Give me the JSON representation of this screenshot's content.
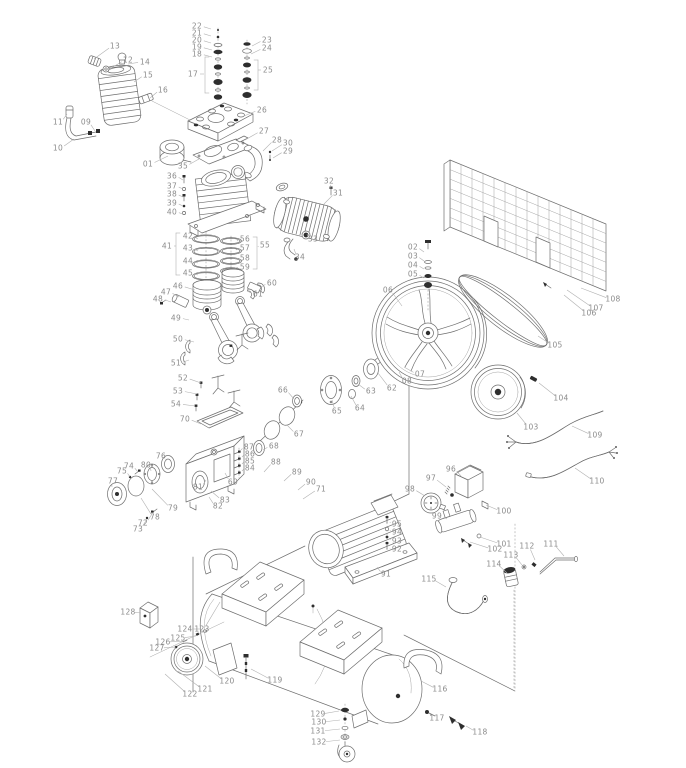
{
  "canvas": {
    "width": 686,
    "height": 768,
    "background": "#ffffff"
  },
  "style": {
    "line_color": "#6e6e6e",
    "label_color": "#8b8b8b",
    "leader_color": "#b1b1b1",
    "dark_fill": "#2e2e2e"
  },
  "callouts": [
    [
      "01",
      148,
      164,
      168,
      156
    ],
    [
      "02",
      413,
      247,
      424,
      252
    ],
    [
      "03",
      413,
      256,
      424,
      261
    ],
    [
      "04",
      413,
      265,
      424,
      269
    ],
    [
      "05",
      413,
      274,
      424,
      278
    ],
    [
      "06",
      388,
      290,
      402,
      306
    ],
    [
      "07",
      420,
      374,
      404,
      367
    ],
    [
      "08",
      407,
      381,
      399,
      372
    ],
    [
      "09",
      86,
      122,
      95,
      131
    ],
    [
      "10",
      58,
      148,
      74,
      139
    ],
    [
      "11",
      58,
      122,
      67,
      114
    ],
    [
      "12",
      128,
      60,
      108,
      70
    ],
    [
      "13",
      115,
      46,
      94,
      59
    ],
    [
      "14",
      145,
      62,
      128,
      64
    ],
    [
      "15",
      148,
      75,
      134,
      82
    ],
    [
      "16",
      163,
      90,
      150,
      98
    ],
    [
      "17",
      193,
      74,
      204,
      74
    ],
    [
      "18",
      197,
      54,
      212,
      57
    ],
    [
      "19",
      197,
      47,
      212,
      50
    ],
    [
      "20",
      197,
      40,
      211,
      43
    ],
    [
      "21",
      197,
      33,
      211,
      36
    ],
    [
      "22",
      197,
      26,
      211,
      29
    ],
    [
      "23",
      267,
      40,
      252,
      46
    ],
    [
      "24",
      267,
      48,
      251,
      54
    ],
    [
      "25",
      268,
      70,
      258,
      70
    ],
    [
      "26",
      262,
      110,
      244,
      116
    ],
    [
      "27",
      264,
      131,
      245,
      140
    ],
    [
      "28",
      277,
      140,
      263,
      151
    ],
    [
      "29",
      288,
      151,
      273,
      158
    ],
    [
      "30",
      288,
      143,
      272,
      151
    ],
    [
      "31",
      338,
      193,
      324,
      204
    ],
    [
      "32",
      329,
      181,
      331,
      189
    ],
    [
      "33",
      313,
      239,
      307,
      234
    ],
    [
      "34",
      300,
      257,
      294,
      249
    ],
    [
      "35",
      183,
      166,
      199,
      159
    ],
    [
      "36",
      172,
      176,
      183,
      180
    ],
    [
      "37",
      172,
      186,
      183,
      189
    ],
    [
      "38",
      172,
      194,
      183,
      197
    ],
    [
      "39",
      172,
      203,
      183,
      206
    ],
    [
      "40",
      172,
      212,
      183,
      214
    ],
    [
      "41",
      167,
      246,
      176,
      246
    ],
    [
      "42",
      188,
      236,
      198,
      239
    ],
    [
      "43",
      188,
      248,
      198,
      251
    ],
    [
      "44",
      188,
      261,
      198,
      263
    ],
    [
      "45",
      188,
      273,
      198,
      275
    ],
    [
      "46",
      178,
      286,
      195,
      290
    ],
    [
      "47",
      166,
      292,
      179,
      297
    ],
    [
      "48",
      158,
      299,
      171,
      302
    ],
    [
      "49",
      176,
      318,
      189,
      320
    ],
    [
      "50",
      178,
      339,
      194,
      342
    ],
    [
      "51",
      176,
      363,
      189,
      360
    ],
    [
      "52",
      183,
      378,
      201,
      383
    ],
    [
      "53",
      178,
      391,
      197,
      394
    ],
    [
      "54",
      176,
      404,
      195,
      406
    ],
    [
      "55",
      265,
      245,
      258,
      247
    ],
    [
      "56",
      245,
      239,
      237,
      241
    ],
    [
      "57",
      245,
      248,
      236,
      250
    ],
    [
      "58",
      245,
      258,
      235,
      259
    ],
    [
      "59",
      245,
      267,
      235,
      268
    ],
    [
      "60",
      272,
      283,
      261,
      287
    ],
    [
      "61",
      258,
      294,
      247,
      291
    ],
    [
      "62",
      392,
      388,
      378,
      373
    ],
    [
      "63",
      371,
      391,
      358,
      384
    ],
    [
      "64",
      360,
      408,
      351,
      396
    ],
    [
      "65",
      337,
      411,
      332,
      400
    ],
    [
      "66",
      283,
      390,
      294,
      399
    ],
    [
      "67",
      299,
      434,
      287,
      425
    ],
    [
      "68",
      274,
      446,
      263,
      450
    ],
    [
      "69",
      233,
      482,
      225,
      473
    ],
    [
      "70",
      185,
      419,
      201,
      424
    ],
    [
      "71",
      321,
      489,
      303,
      499
    ],
    [
      "72",
      143,
      523,
      152,
      514
    ],
    [
      "73",
      138,
      529,
      147,
      519
    ],
    [
      "74",
      129,
      466,
      138,
      472
    ],
    [
      "75",
      122,
      471,
      130,
      477
    ],
    [
      "76",
      161,
      456,
      166,
      461
    ],
    [
      "77",
      113,
      481,
      112,
      487
    ],
    [
      "78",
      155,
      517,
      141,
      498
    ],
    [
      "79",
      173,
      508,
      152,
      489
    ],
    [
      "80",
      146,
      465,
      151,
      471
    ],
    [
      "81",
      198,
      487,
      206,
      480
    ],
    [
      "82",
      218,
      506,
      209,
      497
    ],
    [
      "83",
      225,
      500,
      211,
      491
    ],
    [
      "84",
      250,
      468,
      242,
      471
    ],
    [
      "85",
      250,
      461,
      242,
      464
    ],
    [
      "86",
      250,
      454,
      242,
      457
    ],
    [
      "87",
      249,
      447,
      241,
      450
    ],
    [
      "88",
      276,
      462,
      264,
      472
    ],
    [
      "89",
      297,
      472,
      284,
      481
    ],
    [
      "90",
      311,
      482,
      298,
      490
    ],
    [
      "91",
      386,
      574,
      377,
      567
    ],
    [
      "92",
      397,
      549,
      390,
      548
    ],
    [
      "93",
      397,
      541,
      390,
      539
    ],
    [
      "94",
      397,
      532,
      390,
      530
    ],
    [
      "95",
      397,
      524,
      390,
      522
    ],
    [
      "96",
      451,
      469,
      461,
      476
    ],
    [
      "97",
      431,
      478,
      446,
      487
    ],
    [
      "98",
      410,
      489,
      425,
      496
    ],
    [
      "99",
      437,
      516,
      447,
      519
    ],
    [
      "100",
      504,
      511,
      486,
      505
    ],
    [
      "101",
      504,
      544,
      480,
      537
    ],
    [
      "102",
      495,
      549,
      470,
      542
    ],
    [
      "103",
      531,
      427,
      517,
      413
    ],
    [
      "104",
      561,
      398,
      539,
      383
    ],
    [
      "105",
      555,
      345,
      538,
      336
    ],
    [
      "106",
      589,
      313,
      564,
      295
    ],
    [
      "107",
      596,
      308,
      567,
      290
    ],
    [
      "108",
      613,
      299,
      581,
      288
    ],
    [
      "109",
      595,
      435,
      572,
      426
    ],
    [
      "110",
      597,
      481,
      575,
      468
    ],
    [
      "111",
      551,
      544,
      564,
      556
    ],
    [
      "112",
      527,
      546,
      535,
      560
    ],
    [
      "113",
      511,
      555,
      522,
      565
    ],
    [
      "114",
      494,
      564,
      507,
      573
    ],
    [
      "115",
      429,
      579,
      446,
      587
    ],
    [
      "116",
      440,
      689,
      421,
      681
    ],
    [
      "117",
      437,
      718,
      430,
      714
    ],
    [
      "118",
      480,
      732,
      466,
      726
    ],
    [
      "119",
      275,
      680,
      251,
      669
    ],
    [
      "120",
      227,
      681,
      205,
      666
    ],
    [
      "121",
      205,
      689,
      178,
      671
    ],
    [
      "122",
      190,
      694,
      165,
      674
    ],
    [
      "123",
      202,
      629,
      220,
      602
    ],
    [
      "124",
      185,
      629,
      201,
      629
    ],
    [
      "125",
      178,
      638,
      196,
      636
    ],
    [
      "126",
      163,
      642,
      186,
      641
    ],
    [
      "127",
      157,
      648,
      176,
      647
    ],
    [
      "128",
      128,
      612,
      141,
      613
    ],
    [
      "129",
      318,
      714,
      339,
      711
    ],
    [
      "130",
      319,
      722,
      340,
      720
    ],
    [
      "131",
      318,
      731,
      340,
      729
    ],
    [
      "132",
      319,
      742,
      340,
      740
    ]
  ]
}
